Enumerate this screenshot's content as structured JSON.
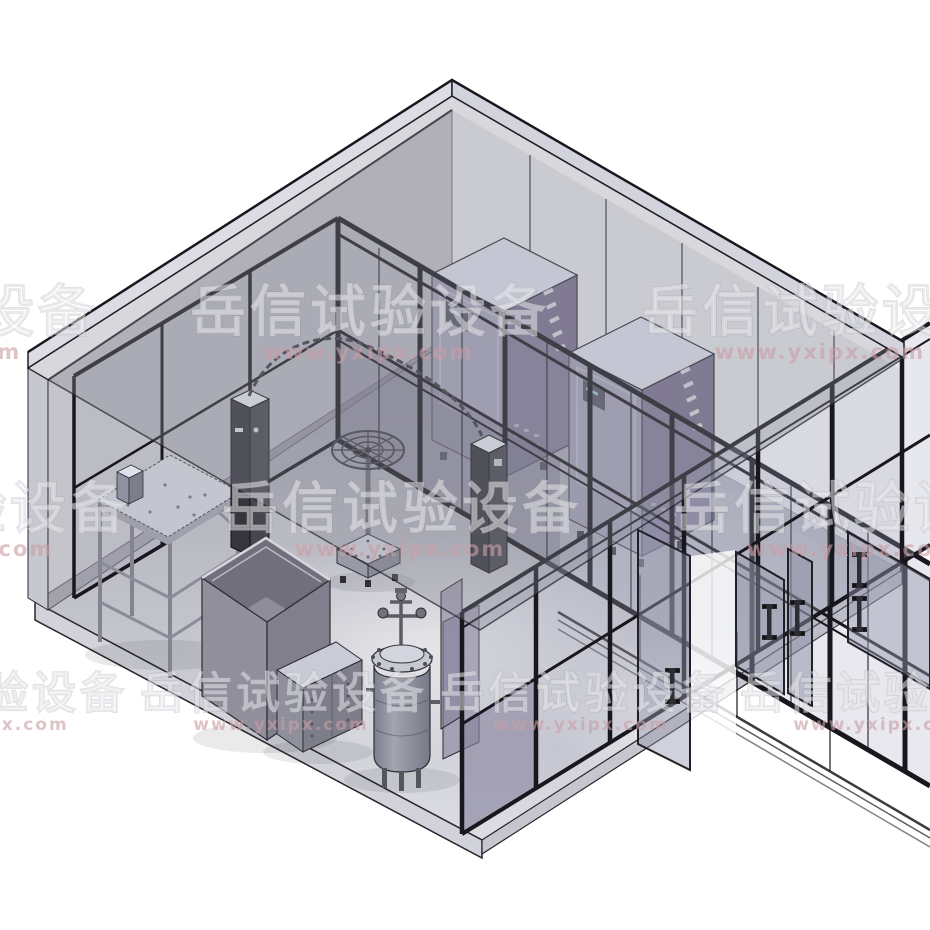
{
  "watermark": {
    "brand_text": "岳信试验设备",
    "url_text": "www.yxipx.com",
    "brand_color": "rgba(255,255,255,0.45)",
    "url_color": "rgba(201,158,164,0.62)"
  },
  "scene": {
    "type": "3d-cad-isometric-render",
    "background_color": "#ffffff",
    "colors": {
      "frame_black": "#17171d",
      "roof_tint": "rgba(138,138,152,0.34)",
      "back_wall_tint": "rgba(126,124,138,0.45)",
      "glass_tint": "rgba(165,168,188,0.26)",
      "floor_light": "#dedee5",
      "floor_dark": "#a4a4ae",
      "chamber_front": "#a6a5b6",
      "chamber_side_purple": "#7b7390",
      "chamber_top": "#e2e5f1",
      "pillar_dark": "#35353c",
      "equipment_gray": "#8f909c"
    },
    "objects": [
      {
        "name": "room-roof"
      },
      {
        "name": "back-left-wall"
      },
      {
        "name": "room-floor"
      },
      {
        "name": "glass-partition-long"
      },
      {
        "name": "glass-partition-left"
      },
      {
        "name": "front-glass-wall"
      },
      {
        "name": "test-chamber-1"
      },
      {
        "name": "test-chamber-2"
      },
      {
        "name": "oscillating-spray-arc"
      },
      {
        "name": "spray-turntable"
      },
      {
        "name": "control-pillar-1"
      },
      {
        "name": "control-pillar-2"
      },
      {
        "name": "drip-test-stand"
      },
      {
        "name": "water-tank"
      },
      {
        "name": "control-cabinet"
      },
      {
        "name": "pressure-immersion-tank"
      },
      {
        "name": "glass-door-1"
      },
      {
        "name": "glass-door-2"
      },
      {
        "name": "glass-door-3"
      },
      {
        "name": "glass-door-4"
      }
    ]
  }
}
